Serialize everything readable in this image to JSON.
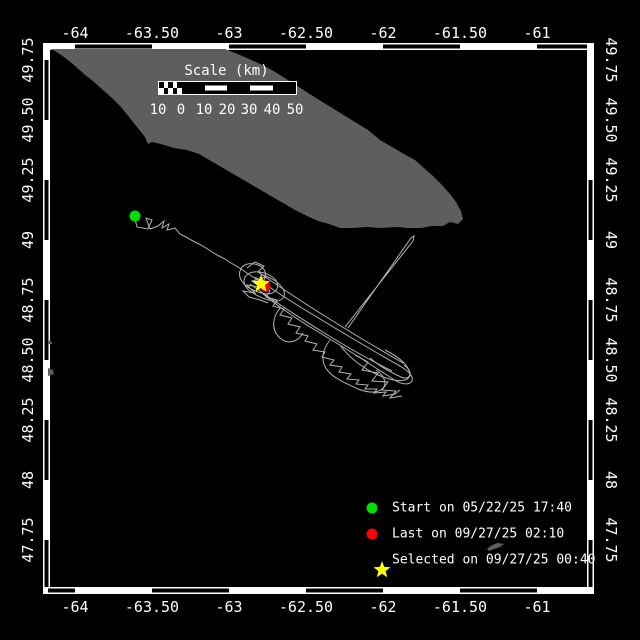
{
  "colors": {
    "background": "#000000",
    "land": "#5e5e5e",
    "track": "#b4b4b4",
    "frame": "#ffffff",
    "start_marker": "#00e000",
    "last_marker": "#ff0000",
    "selected_marker": "#ffff00",
    "text": "#ffffff"
  },
  "axes": {
    "lon": {
      "labels": [
        "-64",
        "-63.50",
        "-63",
        "-62.50",
        "-62",
        "-61.50",
        "-61"
      ],
      "x": [
        75,
        152,
        229,
        306,
        383,
        460,
        537
      ]
    },
    "lat": {
      "labels": [
        "49.75",
        "49.50",
        "49.25",
        "49",
        "48.75",
        "48.50",
        "48.25",
        "48",
        "47.75"
      ],
      "y": [
        60,
        120,
        180,
        240,
        300,
        360,
        420,
        480,
        540
      ]
    }
  },
  "frame": {
    "zebra": {
      "top": [
        [
          75,
          152
        ],
        [
          229,
          306
        ],
        [
          383,
          460
        ],
        [
          537,
          587
        ]
      ],
      "bottom": [
        [
          48,
          75
        ],
        [
          152,
          229
        ],
        [
          306,
          383
        ],
        [
          460,
          537
        ]
      ],
      "left": [
        [
          60,
          120
        ],
        [
          180,
          240
        ],
        [
          300,
          360
        ],
        [
          420,
          480
        ],
        [
          540,
          587
        ]
      ],
      "right": [
        [
          180,
          240
        ],
        [
          300,
          360
        ],
        [
          420,
          480
        ],
        [
          540,
          587
        ]
      ]
    }
  },
  "scale_bar": {
    "title": "Scale (km)",
    "tick_labels": [
      "10",
      "0",
      "10",
      "20",
      "30",
      "40",
      "50"
    ],
    "tick_offsets": [
      0,
      23,
      46,
      69,
      91,
      114,
      137
    ]
  },
  "legend": {
    "items": [
      {
        "marker": "start-dot",
        "color": "#00e000",
        "label": "Start on 05/22/25 17:40"
      },
      {
        "marker": "last-dot",
        "color": "#ff0000",
        "label": "Last on 09/27/25 02:10"
      },
      {
        "marker": "selected-star",
        "color": "#ffff00",
        "label": "Selected on 09/27/25 00:40"
      }
    ],
    "rows_y": [
      508,
      534,
      560
    ],
    "marker_x": 372,
    "text_x": 392
  },
  "map_data": {
    "land_polygon": "50,49 225,49 240,55 256,62 272,70 288,80 302,89 316,98 329,106 342,114 355,122 368,130 380,140 392,147 404,154 415,160 424,168 433,176 442,185 450,194 456,202 461,211 463,219 458,224 450,222 443,226 432,226 421,228 408,228 396,227 381,228 367,227 352,228 340,228 329,224 318,221 307,216 295,210 283,203 271,196 259,189 247,182 235,175 223,168 211,161 199,154 187,150 174,148 161,144 152,142 148,144 145,137 137,127 129,117 121,107 112,98 103,90 94,82 84,74 74,65 64,57 55,51",
    "islets": [
      {
        "points": "487,549 492,545 498,543 504,544 500,547 494,549 489,551"
      },
      {
        "points": "48,368 53,370 54,374 48,376"
      },
      {
        "points": "48,340 52,342 52,344 48,344"
      }
    ],
    "track_paths": [
      "M135 219 L137 227 L148 229 L152 220 L146 218 L150 229 L158 226 L164 221 L162 228 L169 224 L167 230 L175 228 L180 234 L186 237 L193 241 L199 244 L206 248 L212 252 L219 256 L225 259 L231 263 L238 267 L244 271 L250 275 L256 279 L262 283",
      "M262 283 C268 276 266 268 258 265 C250 262 242 264 240 271 C238 278 243 285 251 289 C259 293 268 296 274 292 C280 288 278 280 271 276 C264 272 254 270 248 274 C242 278 243 286 250 291 C257 296 266 300 274 301 C282 302 287 296 283 289 C279 282 270 277 262 275",
      "M247 268 L255 262 L264 266 L258 272 L266 277 L252 281 L260 287 L247 285 L255 293 L243 291 L249 297 L260 300 L268 303",
      "M262 283 L270 291 L266 297 L277 300 L273 306 L284 309 L280 315 L292 318 L288 324 L300 327 L296 333 L308 336 L305 341 L317 344 L313 350 L325 352 L322 357 L334 360 L330 365 L342 367 L339 372 L351 374 L347 379 L359 380 L356 384 L368 385 L365 389 L377 389 L374 393 L386 392 L383 396 L395 394 L400 390",
      "M255 277 C280 295 305 310 330 325 C355 340 380 355 400 366 C408 371 414 376 412 381 C409 386 400 384 393 379 C370 364 345 348 320 333 C300 321 280 308 263 294",
      "M280 308 C272 318 271 330 280 338 C288 345 298 342 303 333",
      "M330 340 C322 350 320 362 328 371 C336 380 348 384 358 389 C366 392 376 394 382 389 C388 384 384 375 376 370",
      "M340 345 C348 356 360 366 374 373 C384 378 396 382 405 380 C412 378 411 370 404 365",
      "M348 328 L411 238 L414 236 L413 241 L345 327",
      "M355 355 L368 362 L362 370 L378 373 L372 381 L388 382 L382 390 L396 391 L390 398 L402 396",
      "M385 350 C395 355 405 362 409 370 C412 376 408 380 401 377 C390 372 378 365 370 358",
      "M250 284 C275 302 300 318 326 334 C350 349 374 362 392 371",
      "M258 272 C284 290 310 307 336 323 C360 338 384 352 403 363"
    ],
    "markers": {
      "start": {
        "x": 135,
        "y": 216
      },
      "last": {
        "x": 265,
        "y": 286
      },
      "selected": {
        "x": 261,
        "y": 284
      }
    }
  }
}
